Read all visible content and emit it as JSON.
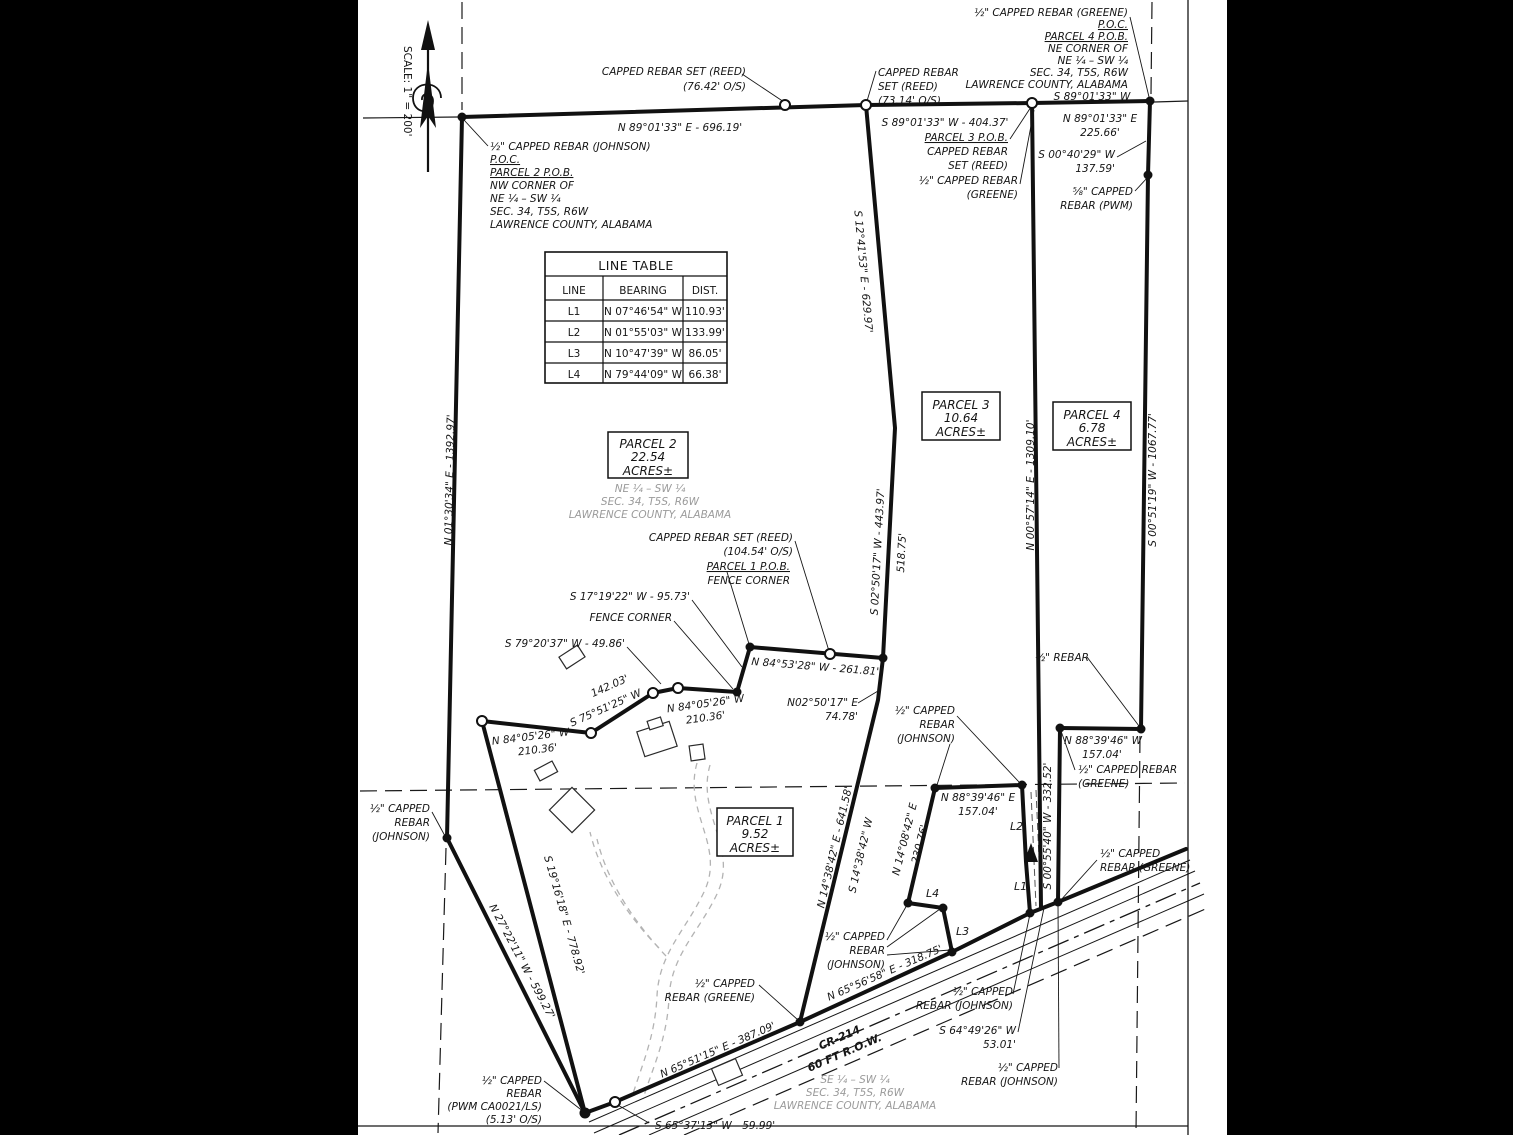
{
  "scale_label": "SCALE: 1\" = 200'",
  "line_table": {
    "title": "LINE TABLE",
    "headers": [
      "LINE",
      "BEARING",
      "DIST."
    ],
    "rows": [
      [
        "L1",
        "N 07°46'54\" W",
        "110.93'"
      ],
      [
        "L2",
        "N 01°55'03\" W",
        "133.99'"
      ],
      [
        "L3",
        "N 10°47'39\" W",
        "86.05'"
      ],
      [
        "L4",
        "N 79°44'09\" W",
        "66.38'"
      ]
    ]
  },
  "parcels": {
    "p1": {
      "name": "PARCEL 1",
      "area": "9.52",
      "unit": "ACRES±"
    },
    "p2": {
      "name": "PARCEL 2",
      "area": "22.54",
      "unit": "ACRES±"
    },
    "p3": {
      "name": "PARCEL 3",
      "area": "10.64",
      "unit": "ACRES±"
    },
    "p4": {
      "name": "PARCEL 4",
      "area": "6.78",
      "unit": "ACRES±"
    }
  },
  "quarter_labels": {
    "ne": [
      "NE ¼ – SW ¼",
      "SEC. 34, T5S, R6W",
      "LAWRENCE COUNTY, ALABAMA"
    ],
    "se": [
      "SE ¼ – SW ¼",
      "SEC. 34, T5S, R6W",
      "LAWRENCE COUNTY, ALABAMA"
    ]
  },
  "top": {
    "poc2": [
      "½\" CAPPED REBAR (JOHNSON)",
      "P.O.C.",
      "PARCEL 2 P.O.B.",
      "NW CORNER OF",
      "NE ¼ – SW ¼",
      "SEC. 34, T5S, R6W",
      "LAWRENCE COUNTY, ALABAMA"
    ],
    "poc4": [
      "½\" CAPPED REBAR (GREENE)",
      "P.O.C.",
      "PARCEL 4 P.O.B.",
      "NE CORNER OF",
      "NE ¼ – SW ¼",
      "SEC. 34, T5S, R6W",
      "LAWRENCE COUNTY, ALABAMA"
    ],
    "reed76": [
      "CAPPED REBAR SET (REED)",
      "(76.42' O/S)"
    ],
    "reed73": [
      "CAPPED REBAR",
      "SET (REED)",
      "(73.14' O/S)"
    ],
    "n8901_696": "N 89°01'33\" E - 696.19'",
    "s8901_404": "S 89°01'33\" W - 404.37'",
    "s8901": "S 89°01'33\" W",
    "n8901_225": [
      "N 89°01'33\" E",
      "225.66'"
    ],
    "pob3": [
      "PARCEL 3 P.O.B.",
      "CAPPED REBAR",
      "SET (REED)"
    ],
    "s0040": [
      "S 00°40'29\" W",
      "137.59'"
    ],
    "pwm58": [
      "⅝\" CAPPED",
      "REBAR (PWM)"
    ]
  },
  "bearings": {
    "w_line": "N 01°30'34\" E - 1392.97'",
    "s1241": "S 12°41'53\" E - 629.97'",
    "p3e": "N 00°57'14\" E - 1309.10'",
    "p4e": "S 00°51'19\" W - 1067.77'",
    "s0250": "S 02°50'17\" W - 443.97'",
    "d51875": "518.75'",
    "n0250": [
      "N02°50'17\" E",
      "74.78'"
    ],
    "n8453": "N 84°53'28\" W - 261.81'",
    "s1719": "S 17°19'22\" W - 95.73'",
    "s7920": "S 79°20'37\" W - 49.86'",
    "d14203": "142.03'",
    "s7551": "S 75°51'25\" W",
    "n8405": [
      "N 84°05'26\" W",
      "210.36'"
    ],
    "n1438e": "N 14°38'42\" E - 641.58'",
    "s1438w": "S 14°38'42\" W",
    "n1408": [
      "N 14°08'42\" E",
      "230.76'"
    ],
    "n8839e": [
      "N 88°39'46\" E",
      "157.04'"
    ],
    "n8839w": [
      "N 88°39'46\" W",
      "157.04'"
    ],
    "s0055": "S 00°55'40\" W - 332.52'",
    "s1916": "S 19°16'18\" E - 778.92'",
    "n2722": "N 27°22'11\" W - 599.27'",
    "n6551": "N 65°51'15\" E - 387.09'",
    "n6556": "N 65°56'58\" E - 318.75'",
    "s6537": "S 65°37'13\" W - 59.99'",
    "s6449": [
      "S 64°49'26\" W",
      "53.01'"
    ]
  },
  "callouts": {
    "reed104": [
      "CAPPED REBAR SET (REED)",
      "(104.54' O/S)"
    ],
    "pob1": [
      "PARCEL 1 P.O.B.",
      "FENCE CORNER"
    ],
    "fence_corner": "FENCE CORNER",
    "half_rebar": "½\" REBAR",
    "greene2": [
      "½\" CAPPED REBAR",
      "(GREENE)"
    ],
    "greene2b": [
      "½\" CAPPED",
      "REBAR (GREENE)"
    ],
    "johnson3": [
      "½\" CAPPED",
      "REBAR",
      "(JOHNSON)"
    ],
    "johnson2": [
      "½\" CAPPED",
      "REBAR (JOHNSON)"
    ],
    "pwm_bottom": [
      "½\" CAPPED",
      "REBAR",
      "(PWM CA0021/LS)",
      "(5.13' O/S)"
    ]
  },
  "road": {
    "name": "CR-214",
    "row": "60 FT R.O.W."
  },
  "seg": {
    "l1": "L1",
    "l2": "L2",
    "l3": "L3",
    "l4": "L4"
  }
}
